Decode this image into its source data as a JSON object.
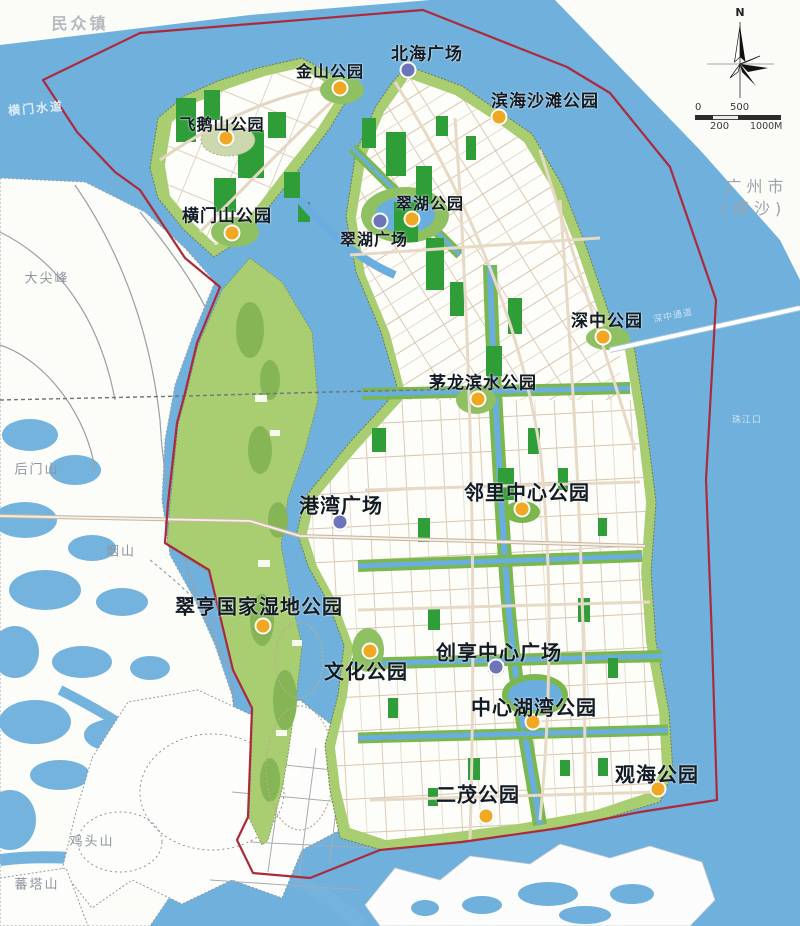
{
  "map": {
    "regions": [
      {
        "text": "民众镇",
        "x": 80,
        "y": 22,
        "style": "town"
      },
      {
        "text": "横门水道",
        "x": 36,
        "y": 108,
        "style": "water",
        "rotate": -5
      },
      {
        "text": "大尖峰",
        "x": 47,
        "y": 277,
        "style": "mountain"
      },
      {
        "text": "后门山",
        "x": 37,
        "y": 468,
        "style": "mountain"
      },
      {
        "text": "烟山",
        "x": 121,
        "y": 550,
        "style": "mountain"
      },
      {
        "text": "鸡头山",
        "x": 92,
        "y": 840,
        "style": "mountain"
      },
      {
        "text": "蕃塔山",
        "x": 37,
        "y": 883,
        "style": "mountain"
      },
      {
        "text": "广州市",
        "x": 757,
        "y": 185,
        "style": "city"
      },
      {
        "text": "(南沙)",
        "x": 754,
        "y": 207,
        "style": "city"
      },
      {
        "text": "深中通道",
        "x": 673,
        "y": 315,
        "style": "water-small",
        "rotate": -11
      },
      {
        "text": "珠江口",
        "x": 747,
        "y": 419,
        "style": "water-small"
      }
    ],
    "parks": [
      {
        "name": "北海广场",
        "type": "plaza",
        "size": 17,
        "label_x": 427,
        "label_y": 52,
        "dot_x": 408,
        "dot_y": 70
      },
      {
        "name": "金山公园",
        "type": "park",
        "size": 16,
        "label_x": 330,
        "label_y": 70,
        "dot_x": 340,
        "dot_y": 88
      },
      {
        "name": "滨海沙滩公园",
        "type": "park",
        "size": 17,
        "label_x": 545,
        "label_y": 99,
        "dot_x": 499,
        "dot_y": 117
      },
      {
        "name": "飞鹅山公园",
        "type": "park",
        "size": 16,
        "label_x": 222,
        "label_y": 123,
        "dot_x": 226,
        "dot_y": 138
      },
      {
        "name": "横门山公园",
        "type": "park",
        "size": 17,
        "label_x": 227,
        "label_y": 214,
        "dot_x": 232,
        "dot_y": 233
      },
      {
        "name": "翠湖公园",
        "type": "park",
        "size": 16,
        "label_x": 430,
        "label_y": 202,
        "dot_x": 412,
        "dot_y": 219
      },
      {
        "name": "翠湖广场",
        "type": "plaza",
        "size": 16,
        "label_x": 374,
        "label_y": 238,
        "dot_x": 380,
        "dot_y": 221
      },
      {
        "name": "深中公园",
        "type": "park",
        "size": 17,
        "label_x": 607,
        "label_y": 319,
        "dot_x": 603,
        "dot_y": 337
      },
      {
        "name": "茅龙滨水公园",
        "type": "park",
        "size": 17,
        "label_x": 483,
        "label_y": 381,
        "dot_x": 478,
        "dot_y": 399
      },
      {
        "name": "邻里中心公园",
        "type": "park",
        "size": 20,
        "label_x": 527,
        "label_y": 491,
        "dot_x": 522,
        "dot_y": 509
      },
      {
        "name": "港湾广场",
        "type": "plaza",
        "size": 20,
        "label_x": 341,
        "label_y": 504,
        "dot_x": 340,
        "dot_y": 522
      },
      {
        "name": "翠亨国家湿地公园",
        "type": "park",
        "size": 20,
        "label_x": 259,
        "label_y": 605,
        "dot_x": 263,
        "dot_y": 626
      },
      {
        "name": "文化公园",
        "type": "park",
        "size": 20,
        "label_x": 366,
        "label_y": 670,
        "dot_x": 370,
        "dot_y": 651
      },
      {
        "name": "创享中心广场",
        "type": "plaza",
        "size": 20,
        "label_x": 499,
        "label_y": 651,
        "dot_x": 496,
        "dot_y": 667
      },
      {
        "name": "中心湖湾公园",
        "type": "park",
        "size": 20,
        "label_x": 534,
        "label_y": 706,
        "dot_x": 533,
        "dot_y": 722
      },
      {
        "name": "观海公园",
        "type": "park",
        "size": 20,
        "label_x": 657,
        "label_y": 773,
        "dot_x": 658,
        "dot_y": 789
      },
      {
        "name": "二茂公园",
        "type": "park",
        "size": 20,
        "label_x": 478,
        "label_y": 793,
        "dot_x": 486,
        "dot_y": 816
      }
    ],
    "marker_colors": {
      "park": "#f0a823",
      "plaza": "#6d74b9"
    },
    "boundary_color": "#ac2a3c",
    "compass": {
      "north_label": "N"
    },
    "scale_bar": {
      "top_labels": [
        "0",
        "500"
      ],
      "bottom_labels": [
        "200",
        "1000M"
      ]
    }
  }
}
